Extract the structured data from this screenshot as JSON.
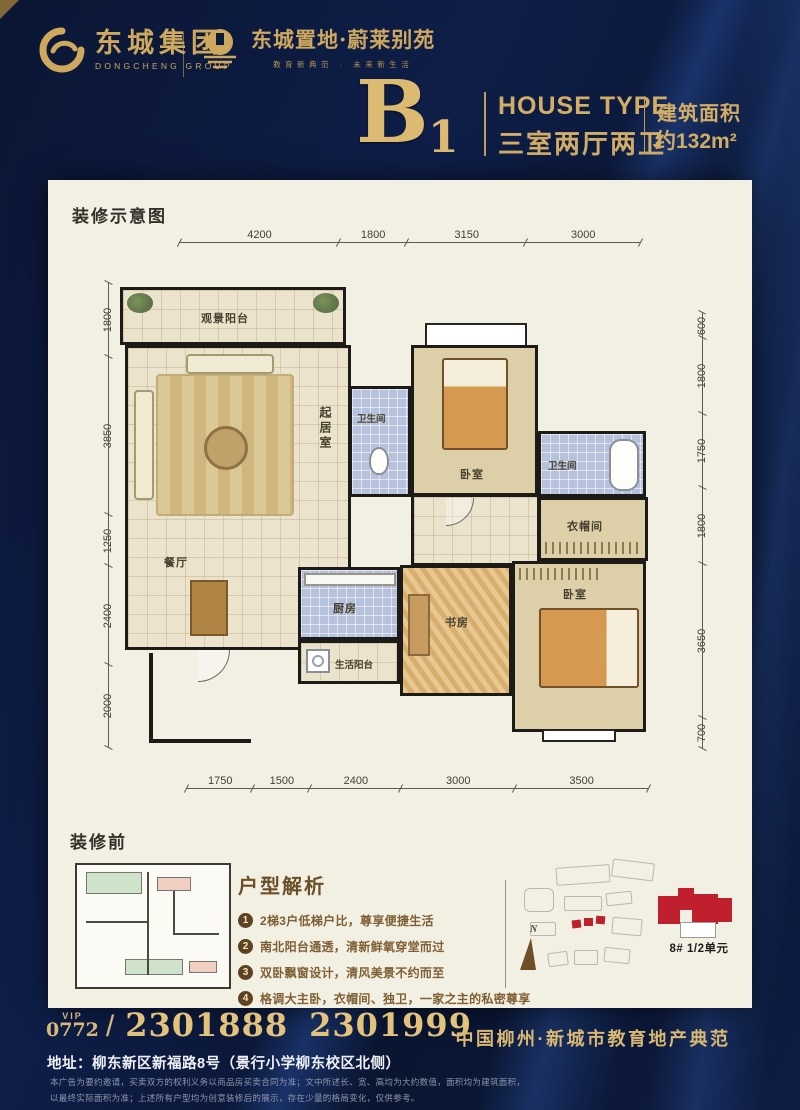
{
  "header": {
    "group_logo": {
      "name_cn": "东城集团",
      "name_en": "DONGCHENG GROUP"
    },
    "project_logo": {
      "name": "东城置地·蔚莱别苑",
      "tagline": "教育新典范 · 未来新生活"
    }
  },
  "title": {
    "type_letter": "B",
    "type_number": "1",
    "house_type_en": "HOUSE TYPE",
    "house_type_cn": "三室两厅两卫",
    "area_label": "建筑面积",
    "area_value": "约132m²"
  },
  "plan": {
    "section_label": "装修示意图",
    "dims_top": [
      "4200",
      "1800",
      "3150",
      "3000"
    ],
    "dims_bottom": [
      "1750",
      "1500",
      "2400",
      "3000",
      "3500"
    ],
    "dims_left": [
      "1800",
      "3850",
      "1250",
      "2400",
      "2000"
    ],
    "dims_right": [
      "600",
      "1800",
      "1750",
      "1800",
      "3650",
      "700"
    ],
    "rooms": {
      "view_balcony": "观景阳台",
      "living": "起居室",
      "bath1": "卫生间",
      "bedroom1": "卧室",
      "bath2": "卫生间",
      "closet": "衣帽间",
      "dining": "餐厅",
      "kitchen": "厨房",
      "study": "书房",
      "life_balcony": "生活阳台",
      "bedroom2": "卧室"
    }
  },
  "before": {
    "section_label": "装修前"
  },
  "analysis": {
    "heading": "户型解析",
    "points": [
      {
        "num": "1",
        "text": "2梯3户低梯户比，尊享便捷生活"
      },
      {
        "num": "2",
        "text": "南北阳台通透，清新鲜氧穿堂而过"
      },
      {
        "num": "3",
        "text": "双卧飘窗设计，清风美景不约而至"
      },
      {
        "num": "4",
        "text": "格调大主卧，衣帽间、独卫，一家之主的私密尊享"
      }
    ]
  },
  "siteplan": {
    "compass_label": "N",
    "unit_label": "8# 1/2单元"
  },
  "footer": {
    "vip_label": "VIP",
    "area_code": "0772",
    "separator": "/",
    "phone1": "2301888",
    "phone2": "2301999",
    "address": "地址：柳东新区新福路8号（景行小学柳东校区北侧）",
    "slogan": "中国柳州·新城市教育地产典范",
    "disclaimer1": "本广告为要约邀请，买卖双方的权利义务以商品房买卖合同为准；文中所述长、宽、高均为大约数值，面积均为建筑面积，",
    "disclaimer2": "以最终实际面积为准；上述所有户型均为创意装修后的展示，存在少量的格局变化，仅供参考。"
  },
  "colors": {
    "gold": "#CDA85E",
    "navy": "#0B1634",
    "red": "#C0202D",
    "tile_blue": "#B6C2DC",
    "cream": "#F2EFE3"
  }
}
